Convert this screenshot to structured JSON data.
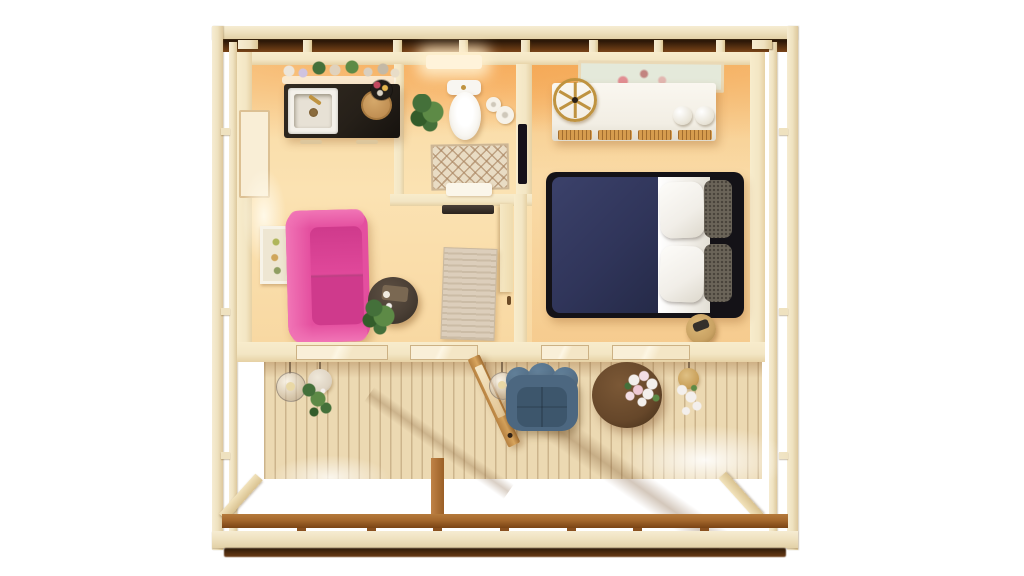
{
  "meta": {
    "description": "Top-down 3D dollhouse render of a one-bedroom timber cabin with front deck",
    "view": "top-down"
  },
  "colors": {
    "frame_cream": "#efe2c0",
    "roof_brown": "#7a4418",
    "wall_cream": "#f3e6c4",
    "counter_dark": "#262019",
    "sink_white": "#f4f1ea",
    "toilet_white": "#f8f6f1",
    "rug_bath": "#e9dcc4",
    "wardrobe_white": "#f2eee4",
    "rattan": "#d69c4e",
    "gold": "#bf9340",
    "bed_frame": "#141217",
    "duvet_navy": "#30355a",
    "sheet_white": "#f1eee8",
    "pillow_dark": "#6b6459",
    "stool_tan": "#c9a263",
    "sofa_pink": "#e44f9f",
    "sofa_pink_light": "#f175b6",
    "sofa_pink_deep": "#cf3a8c",
    "coffee_table": "#4a3f35",
    "rug_living": "#dccebb",
    "chair_blue": "#4c6780",
    "chair_blue_dark": "#3d566c",
    "decktable_brown": "#66472a",
    "deck_wood": "#ecd9b2",
    "fascia_brown": "#a4672c",
    "plant_green": "#44703a",
    "plant_green_light": "#5d8a46",
    "flower_white": "#f3efec",
    "pot_white": "#ded3c2"
  },
  "rooms": {
    "kitchen": {
      "name": "Kitchen",
      "items": [
        "farmhouse sink",
        "gold faucet",
        "dark stone countertop",
        "round cutting board",
        "shelf with jars and plants",
        "flower vase",
        "drawer handles"
      ]
    },
    "bathroom": {
      "name": "Bathroom",
      "items": [
        "toilet",
        "potted plant",
        "toilet paper rolls",
        "diamond pattern rug",
        "white bath mat",
        "ceiling light"
      ]
    },
    "bedroom": {
      "name": "Bedroom",
      "items": [
        "double bed with navy duvet",
        "white pillows",
        "knit cushions",
        "white dresser with rattan doors",
        "gold wheel clock",
        "framed artwork",
        "round side stool"
      ]
    },
    "living_room": {
      "name": "Living room",
      "items": [
        "pink velvet sofa",
        "round coffee table",
        "potted plant",
        "beige area rug",
        "framed wall art",
        "interior door"
      ]
    },
    "deck": {
      "name": "Deck",
      "items": [
        "plank flooring",
        "open front door",
        "glass pendant lamps",
        "hanging plant baskets",
        "blue tufted lounge chair",
        "round brown table",
        "white flower bouquet"
      ]
    }
  },
  "structure": {
    "elements": [
      "timber post-and-beam frame",
      "dark roof shadow band",
      "corner braces",
      "front rail",
      "center post"
    ]
  }
}
